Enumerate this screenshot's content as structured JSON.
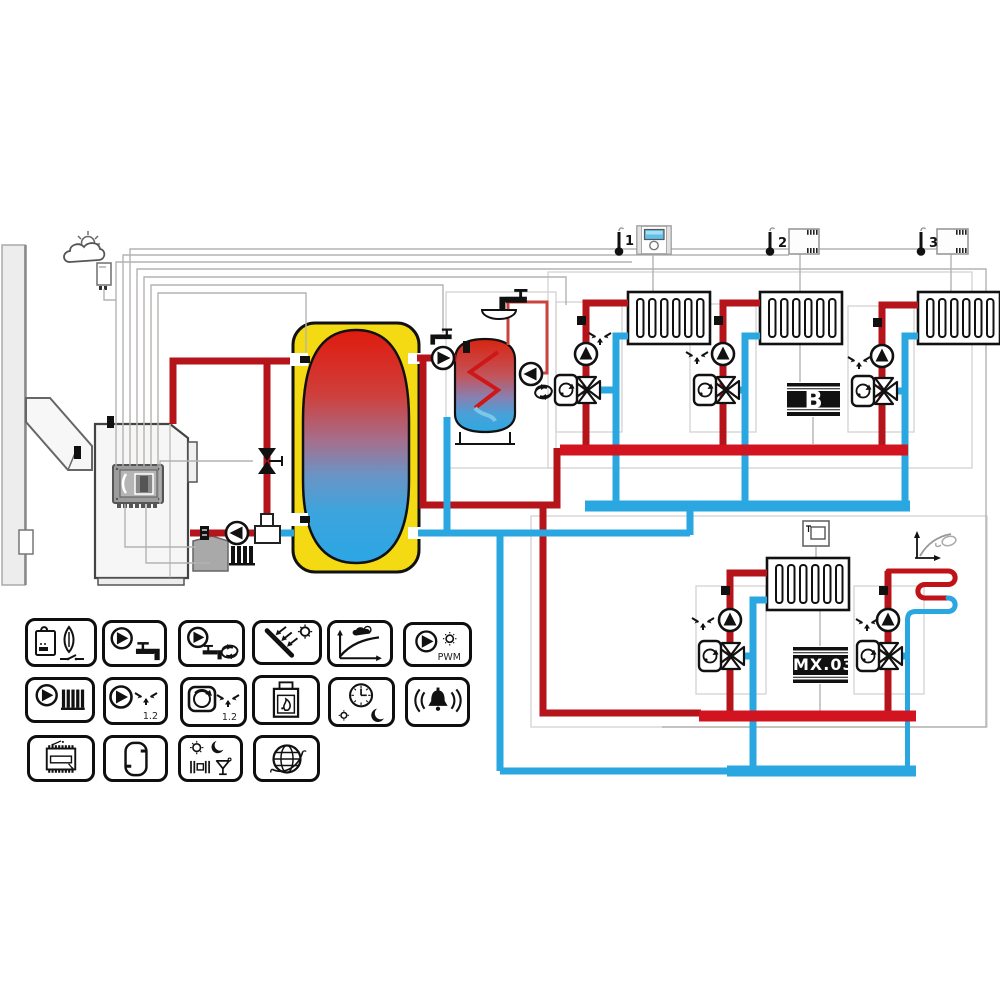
{
  "labels": {
    "thermostat_1": "1",
    "thermostat_2": "2",
    "thermostat_3": "3",
    "module_b": "B",
    "module_mx": "MX.03",
    "pwm": "PWM",
    "mixer_12_a": "1.2",
    "mixer_12_b": "1.2"
  },
  "colors": {
    "hot_pipe": "#b5141b",
    "hot_manifold": "#d11420",
    "hot_thin": "#c8443c",
    "cold_pipe": "#2aa7e0",
    "tank_insulation": "#f4da12",
    "tank_hot_top": "#df1b0e",
    "tank_cold_bottom": "#2ba6e4",
    "panel_screen": "#62c0e8"
  },
  "icon_grid": {
    "rows": [
      [
        "boiler-ignition",
        "dhw-pump",
        "dhw-circulation-pump",
        "solar-collector",
        "weather-curve",
        "pwm-solar-pump"
      ],
      [
        "heating-pump",
        "mixer-circuit-pump",
        "mixer-servo",
        "fireplace",
        "time-schedule",
        "alarm"
      ],
      [
        "expansion-module",
        "buffer-tank",
        "operating-modes",
        "internet-module"
      ]
    ]
  },
  "diagram_icons": [
    "weather-cloud-sun-icon",
    "outdoor-sensor",
    "chimney-wall",
    "pellet-boiler",
    "boiler-controller",
    "buffer-tank",
    "dhw-tank",
    "tap-icon",
    "basin-icon",
    "circulation-arrows-icon",
    "room-thermostat-1",
    "room-panel-1",
    "room-thermostat-2",
    "room-thermostat-3",
    "radiator",
    "mixing-valve",
    "valve-servo",
    "circulation-pump",
    "floor-heating-coil",
    "heating-curve-icon",
    "room-panel-lower",
    "module-b",
    "module-mx03"
  ]
}
